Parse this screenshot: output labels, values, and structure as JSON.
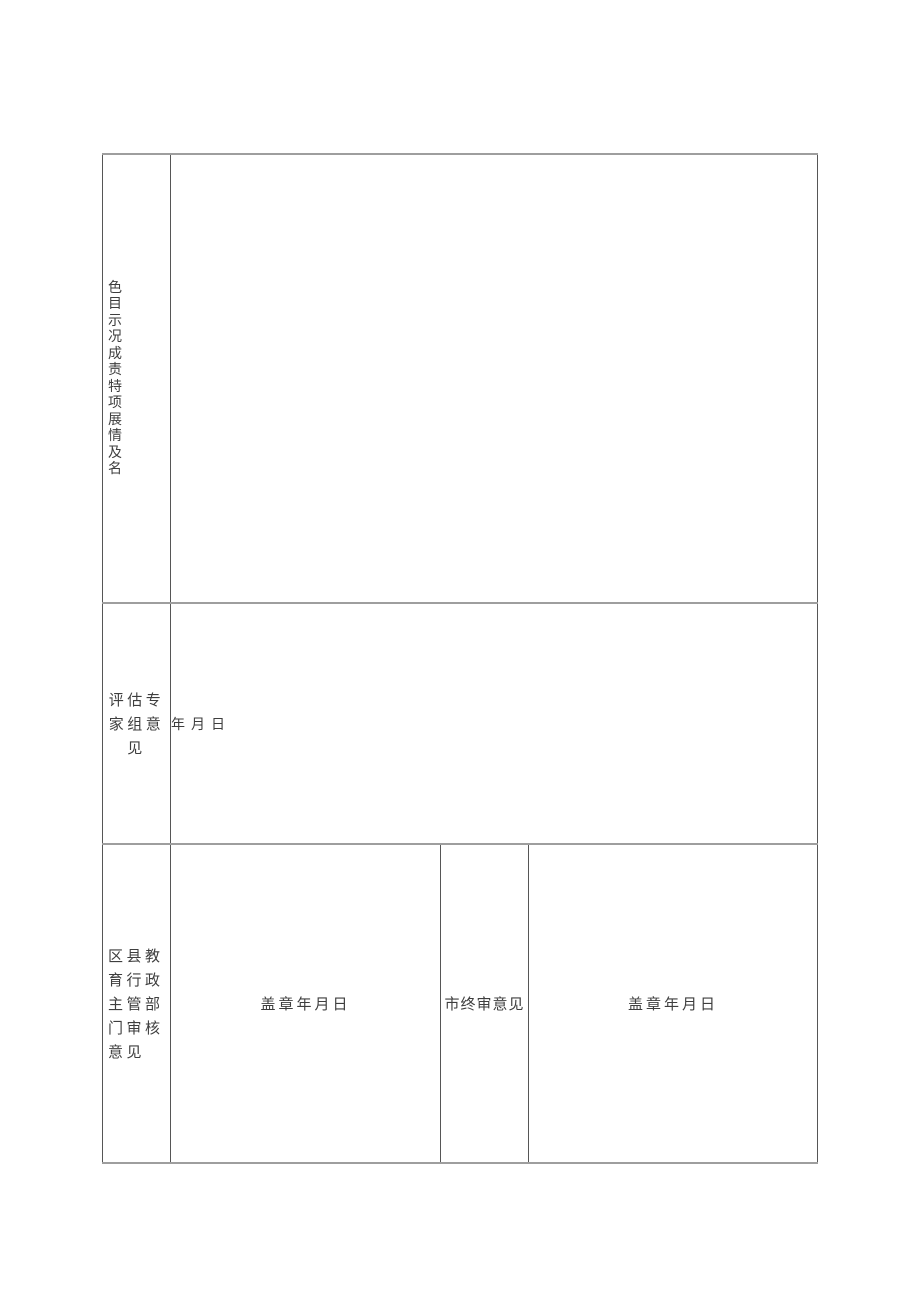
{
  "form": {
    "row_project": {
      "label_vertical": "色目示况成责特项展情及名",
      "content": ""
    },
    "row_expert": {
      "label": "评估专家组意见",
      "date_placeholder": "年月日"
    },
    "row_review": {
      "label": "区县教育行政主管部门审核意见",
      "district_stamp_date": "盖章年月日",
      "city_final_label": "市终审意见",
      "city_stamp_date": "盖章年月日"
    },
    "colors": {
      "horizontal_border": "#9e9e9e",
      "vertical_border": "#565656",
      "text": "#3e3e3e",
      "page_background": "#ffffff"
    }
  }
}
